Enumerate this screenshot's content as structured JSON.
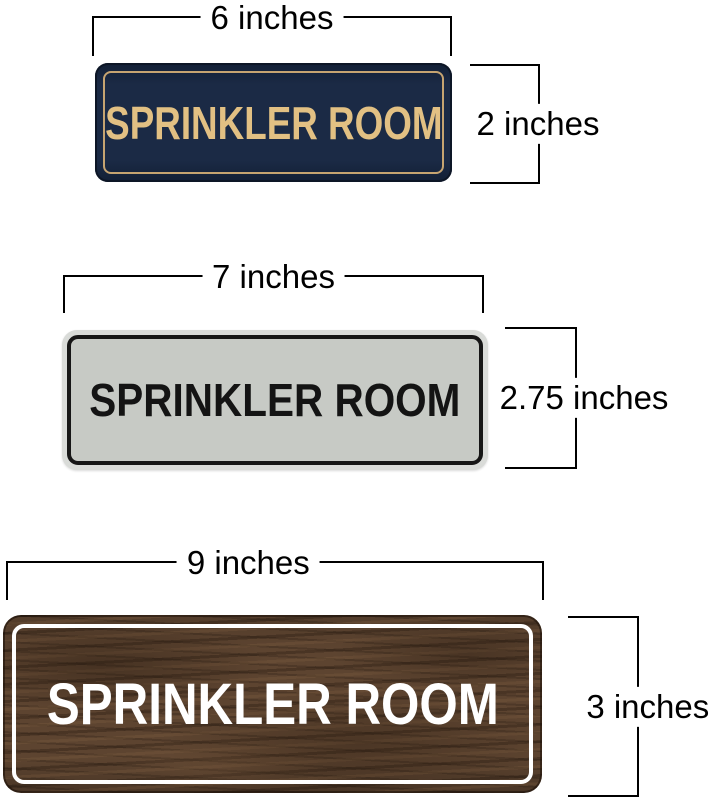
{
  "page": {
    "background": "#ffffff",
    "dimension_line_color": "#000000"
  },
  "signs": [
    {
      "name": "navy-gold-sign",
      "text": "SPRINKLER ROOM",
      "width_dimension": "6 inches",
      "height_dimension": "2 inches",
      "colors": {
        "background": "#1b2a45",
        "frame": "#c6a471",
        "text": "#e2c083"
      }
    },
    {
      "name": "silver-black-sign",
      "text": "SPRINKLER ROOM",
      "width_dimension": "7 inches",
      "height_dimension": "2.75 inches",
      "colors": {
        "background": "#c7cac5",
        "rim": "#d9dbd8",
        "frame": "#161616",
        "text": "#141414"
      }
    },
    {
      "name": "walnut-white-sign",
      "text": "SPRINKLER ROOM",
      "width_dimension": "9 inches",
      "height_dimension": "3 inches",
      "colors": {
        "background": "#5d4430",
        "frame": "#ffffff",
        "text": "#ffffff"
      }
    }
  ]
}
